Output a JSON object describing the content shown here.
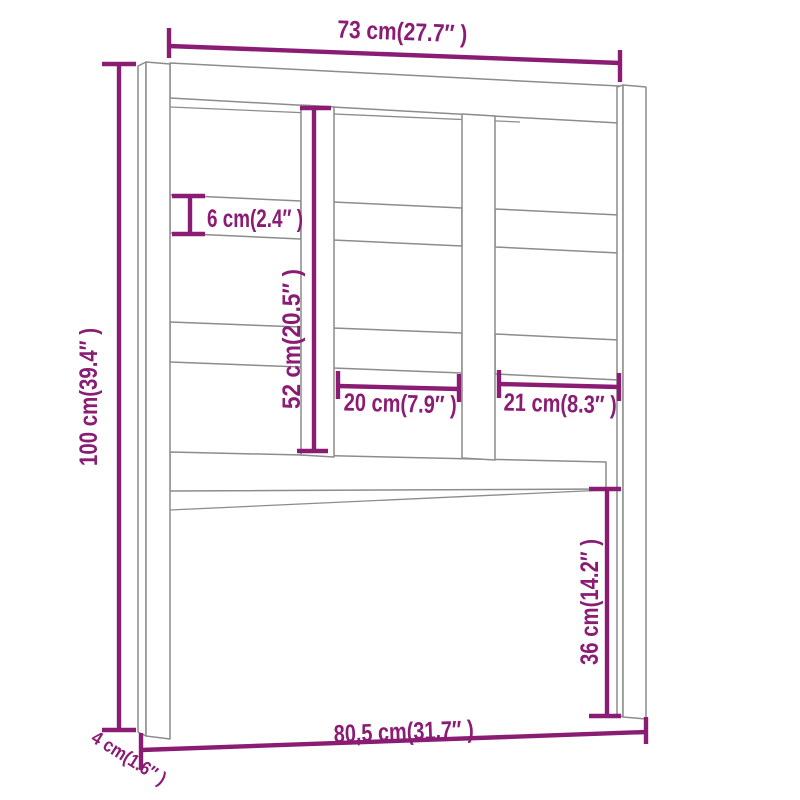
{
  "figure": {
    "type": "dimension-drawing",
    "subject": "bed headboard front view",
    "colors": {
      "dimension_purple": "#8A1C73",
      "line_gray": "#8C8C8C",
      "background": "#FFFFFF"
    }
  },
  "dims": {
    "top_width": "73 cm(27.7″ )",
    "left_height": "100 cm(39.4″ )",
    "rail_height": "6 cm(2.4″ )",
    "inner_height": "52 cm(20.5″ )",
    "mid_panel_width": "20 cm(7.9″ )",
    "right_panel_width": "21 cm(8.3″ )",
    "leg_height": "36 cm(14.2″ )",
    "bottom_width": "80,5 cm(31.7″ )",
    "post_depth": "4 cm(1.6″ )"
  }
}
